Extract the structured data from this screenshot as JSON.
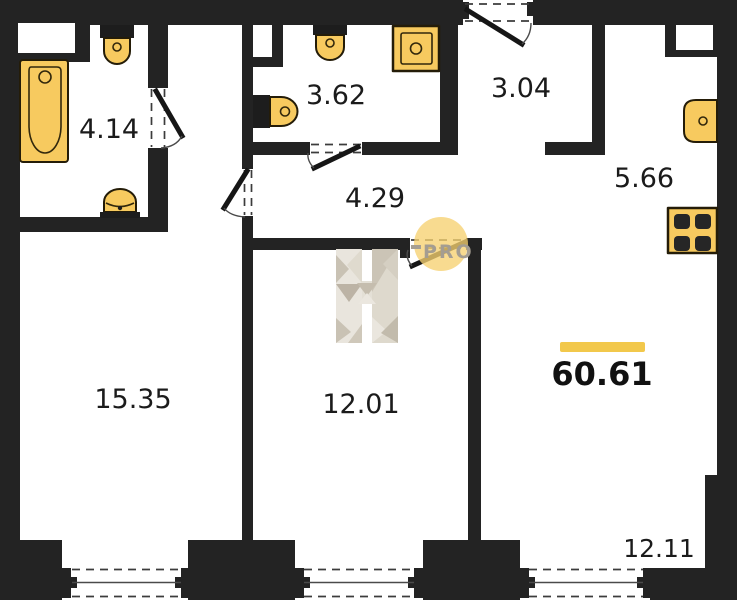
{
  "plan": {
    "title": "apartment-floor-plan",
    "rooms": [
      {
        "name": "bathroom",
        "area": "4.14"
      },
      {
        "name": "bathroom-2",
        "area": "3.62"
      },
      {
        "name": "entry-hall",
        "area": "3.04"
      },
      {
        "name": "corridor",
        "area": "4.29"
      },
      {
        "name": "kitchen",
        "area": "5.66"
      },
      {
        "name": "room-large",
        "area": "15.35"
      },
      {
        "name": "room-middle",
        "area": "12.01"
      },
      {
        "name": "living-room",
        "area": "12.11"
      }
    ],
    "total": {
      "value": "60.61"
    },
    "fixtures": [
      "bathtub",
      "sink",
      "toilet",
      "shower",
      "kitchen-sink",
      "stove"
    ]
  },
  "watermark": {
    "brand": "PRO"
  },
  "colors": {
    "wall": "#232323",
    "fixture": "#f7ca5f",
    "accent_bar": "#f2c84b",
    "watermark_circle": "#f6d171",
    "watermark_text": "#a49d91",
    "background": "#ffffff",
    "label": "#1b1b1b"
  }
}
